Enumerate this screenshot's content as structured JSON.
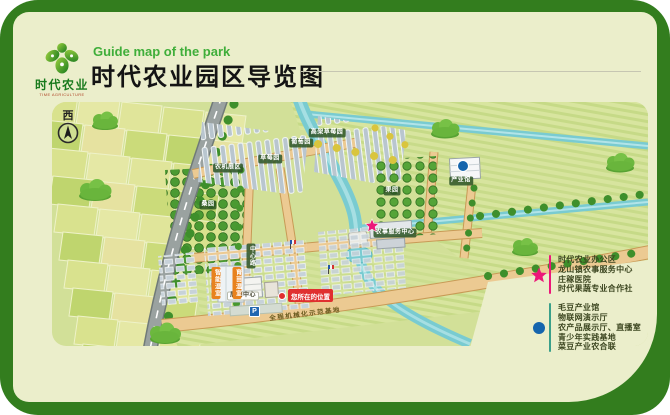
{
  "header": {
    "logo": {
      "brand": "时代农业",
      "brand_en": "TIME AGRICULTURE"
    },
    "subtitle": "Guide map of the park",
    "title": "时代农业园区导览图"
  },
  "map": {
    "compass": "西",
    "you_are_here": "您所在的位置",
    "road_banner": "全程机械化示范基地",
    "parking": "P",
    "labels": [
      {
        "text": "农机展区"
      },
      {
        "text": "葡萄园"
      },
      {
        "text": "草莓园"
      },
      {
        "text": "高架草莓园"
      },
      {
        "text": "桑园"
      },
      {
        "text": "果园"
      },
      {
        "text": "产业馆"
      },
      {
        "text": "农事服务中心"
      },
      {
        "text": "展销中心"
      },
      {
        "text": "智能温室"
      },
      {
        "text": "育苗温室"
      },
      {
        "text": "中心路"
      }
    ]
  },
  "legend": {
    "star_items": [
      "时代农业办公区",
      "龙山镇农事服务中心",
      "庄稼医院",
      "时代果蔬专业合作社"
    ],
    "dot_items": [
      "毛豆产业馆",
      "物联网演示厅",
      "农产品展示厅、直播室",
      "青少年实践基地",
      "菜豆产业农合联"
    ]
  },
  "colors": {
    "frame_green": "#337d1e",
    "card_bg": "#ebeecb",
    "accent_green": "#3fae3a",
    "star_pink": "#ec1779",
    "dot_blue": "#1565ad",
    "you_are_here_red": "#e02f2f"
  }
}
